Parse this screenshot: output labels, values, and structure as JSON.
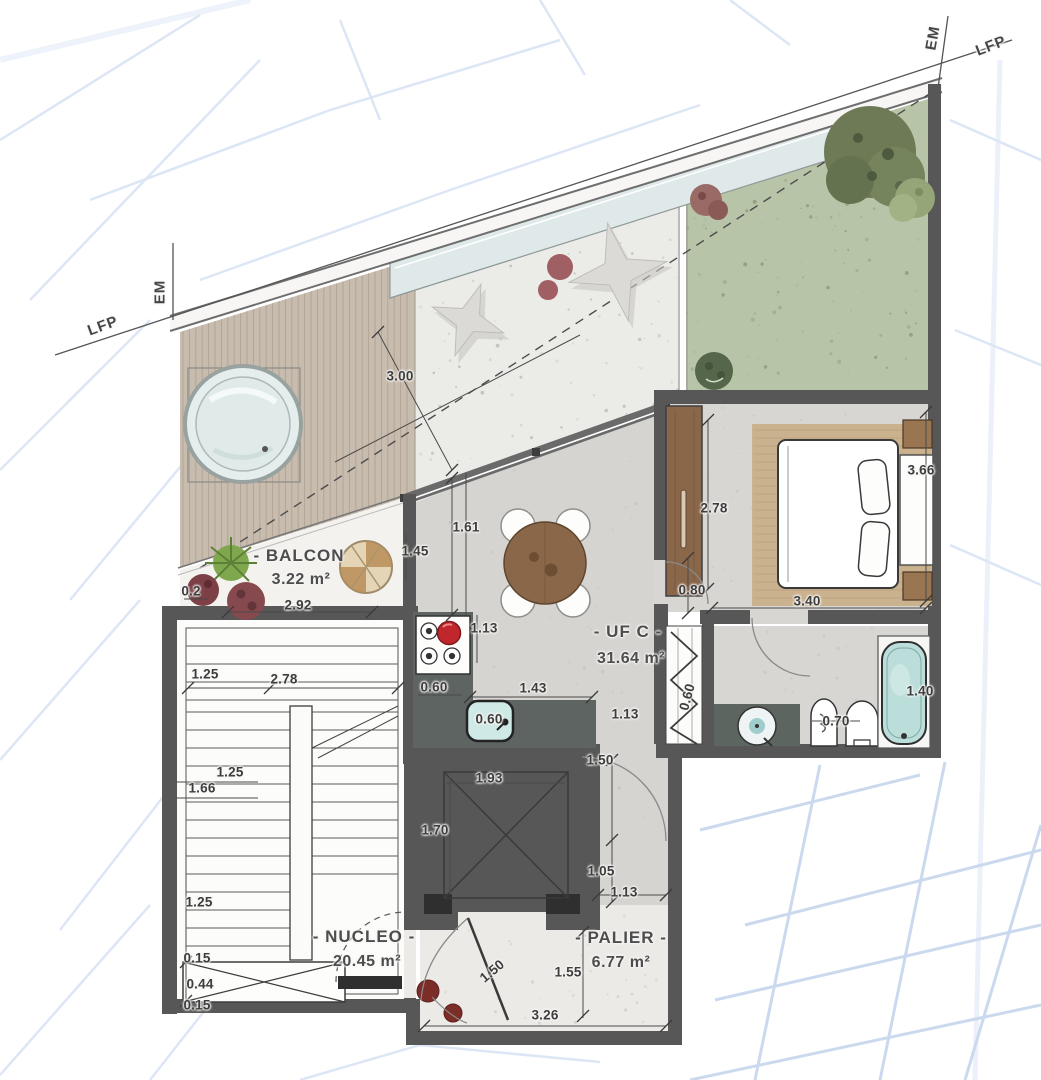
{
  "plan": {
    "type": "architectural floor plan",
    "corner_markers": {
      "left_lfp": "LFP",
      "left_em": "EM",
      "right_em": "EM",
      "right_lfp": "LFP"
    },
    "rooms": {
      "balcon": {
        "label": "- BALCON",
        "area": "3.22 m²"
      },
      "uf_c": {
        "label": "- UF C -",
        "area": "31.64 m²"
      },
      "nucleo": {
        "label": "- NUCLEO -",
        "area": "20.45 m²"
      },
      "palier": {
        "label": "- PALIER -",
        "area": "6.77 m²"
      }
    },
    "dimensions": {
      "terrace_depth": "3.00",
      "balcon_width": "2.92",
      "balcon_dim": "1.45",
      "balcon_side": "0.2",
      "living_height": "1.61",
      "kitchen_depth": "1.13",
      "kitchen_counter": "0.60",
      "kitchen_run": "1.43",
      "sink_width": "0.60",
      "closet_depth": "0.60",
      "hall_passage": "1.13",
      "hall_door": "1.50",
      "bedroom_depth": "2.78",
      "bedroom_door": "0.80",
      "bedroom_width": "3.40",
      "bedroom_length": "3.66",
      "bathtub_length": "1.40",
      "bidet_width": "0.70",
      "stairs_top": "1.25",
      "stairs_span": "2.78",
      "stairs_mid": "1.25",
      "stairs_run": "1.66",
      "stairs_low": "1.25",
      "duct_top": "0.15",
      "duct_height": "0.44",
      "duct_bottom": "0.15",
      "elevator_width": "1.93",
      "elevator_depth": "1.70",
      "hall_length": "1.05",
      "hall_width": "1.13",
      "palier_door": "1.50",
      "palier_depth": "1.55",
      "palier_width": "3.26"
    },
    "colors": {
      "wall": "#575757",
      "floor": "#d6d4d0",
      "grass": "#b7c4a8",
      "deck": "#c7bcae",
      "gravel": "#ebebe8",
      "water": "#bcdeda",
      "wood": "#8a6748",
      "counter": "#5d6461",
      "accent_red": "#c0272d",
      "map_lines": "#dbe4f3"
    }
  }
}
